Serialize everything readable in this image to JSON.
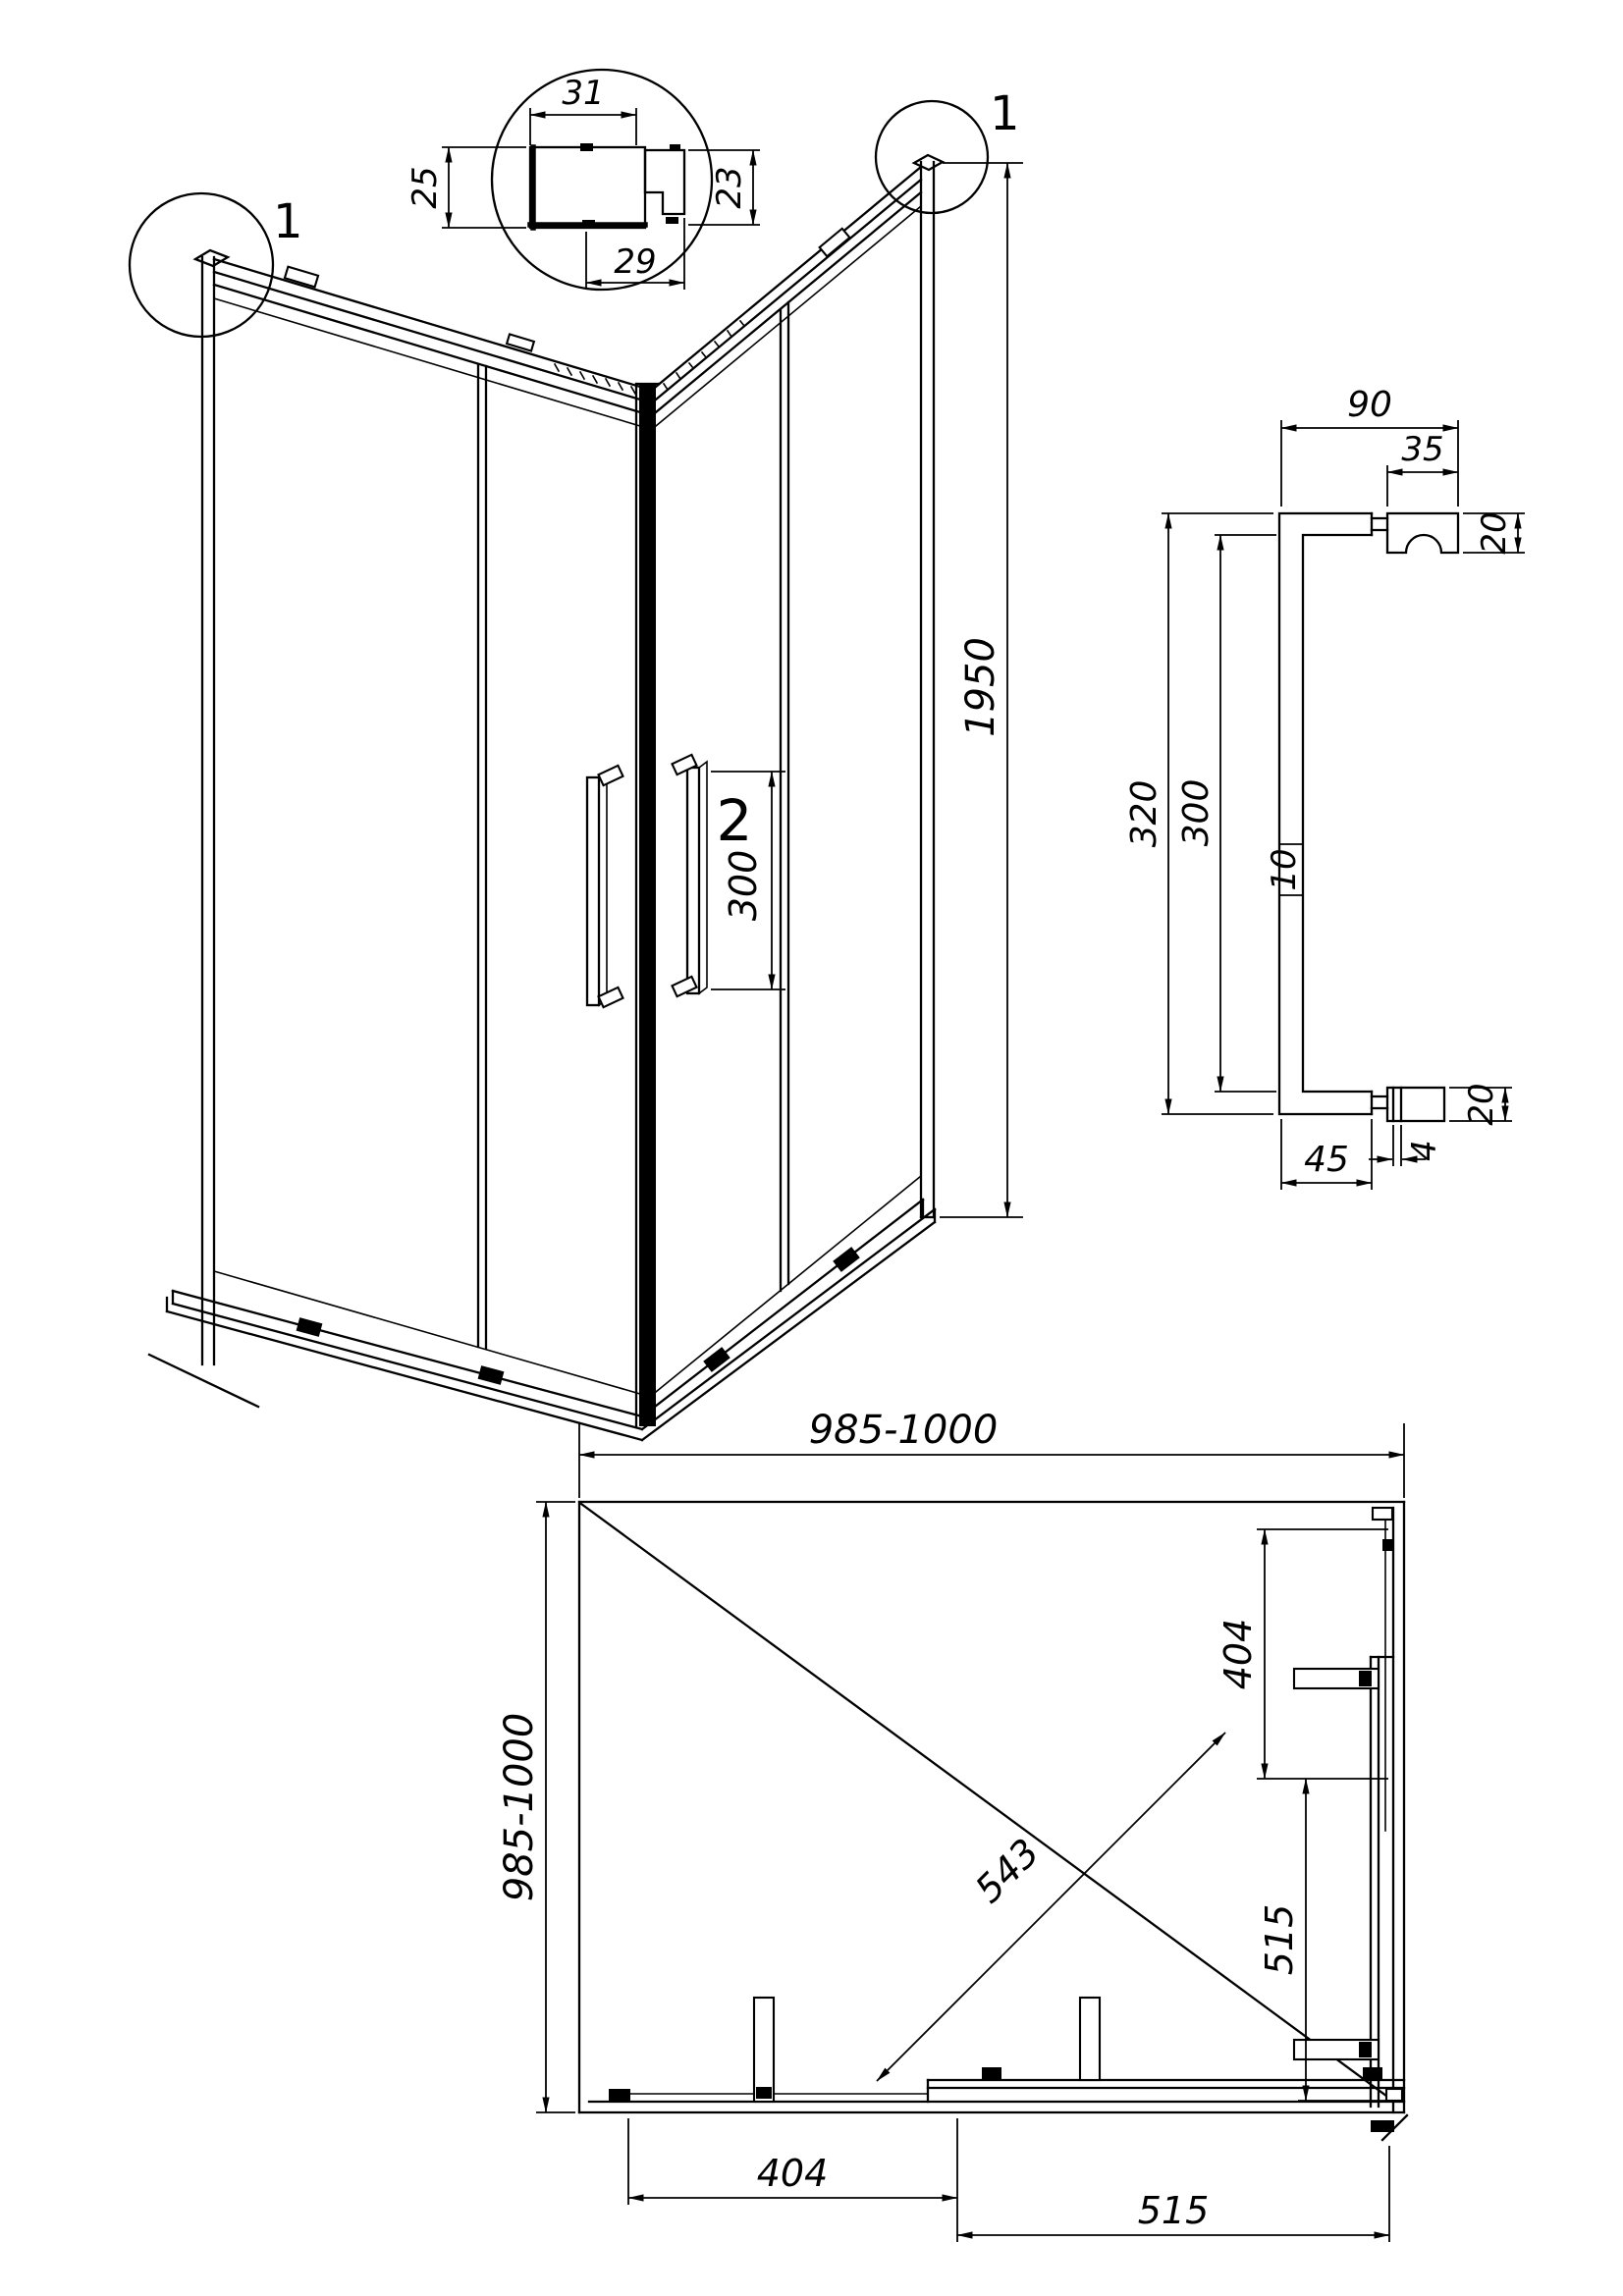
{
  "drawing": {
    "colors": {
      "line": "#000000",
      "background": "#ffffff"
    },
    "detail_labels": {
      "left_corner": "1",
      "right_corner": "1",
      "handle": "2"
    },
    "profile_section": {
      "width_top": "31",
      "height_left": "25",
      "width_bottom": "29",
      "height_right": "23"
    },
    "front_view": {
      "height": "1950",
      "handle_span": "300"
    },
    "handle_view": {
      "top_width": "90",
      "pad_width": "35",
      "pad_top_thickness": "20",
      "overall_height": "320",
      "inner_height": "300",
      "bar_thickness": "10",
      "bottom_width": "45",
      "glass_gap": "4",
      "pad_bottom_thickness": "20"
    },
    "plan_view": {
      "width": "985-1000",
      "depth": "985-1000",
      "bottom_fixed_panel": "404",
      "bottom_door": "515",
      "side_fixed_panel": "404",
      "side_door": "515",
      "diagonal_opening": "543"
    }
  }
}
